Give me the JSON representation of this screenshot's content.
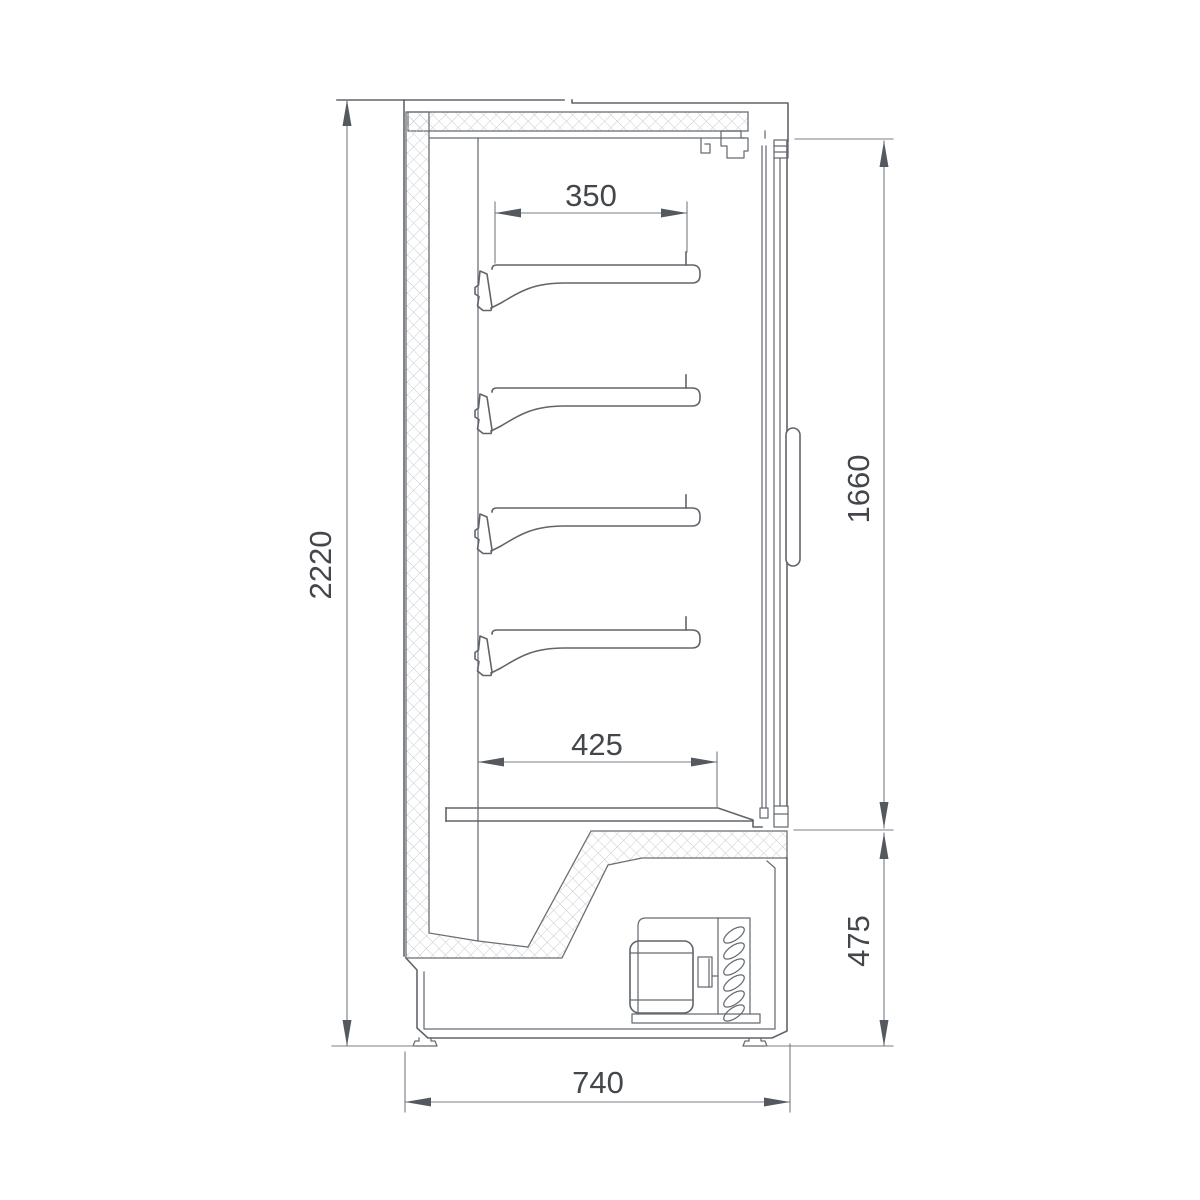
{
  "document": {
    "type": "technical-drawing",
    "view": "side-section"
  },
  "colors": {
    "background": "#ffffff",
    "line": "#60656b",
    "dimension_line": "#787d83",
    "dimension_text": "#43474c",
    "hatch": "#c9ccd0"
  },
  "dimensions": {
    "overall_height": "2220",
    "shelf_depth": "350",
    "door_opening_height": "1660",
    "bottom_shelf_depth": "425",
    "machine_base_height": "475",
    "overall_depth": "740"
  }
}
